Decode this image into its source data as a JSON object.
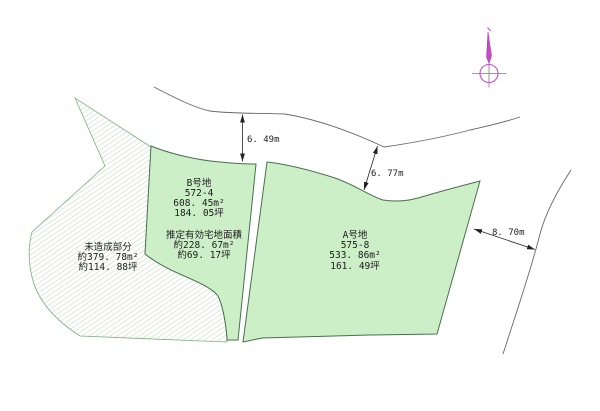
{
  "drawing": {
    "parcel_b": {
      "name": "B号地",
      "lot": "572-4",
      "area_m2": "608. 45m²",
      "area_tsubo": "184. 05坪"
    },
    "effective_area": {
      "title": "推定有効宅地面積",
      "area_m2": "約228. 67m²",
      "area_tsubo": "約69. 17坪"
    },
    "parcel_a": {
      "name": "A号地",
      "lot": "575-8",
      "area_m2": "533. 86m²",
      "area_tsubo": "161. 49坪"
    },
    "undeveloped": {
      "name": "未造成部分",
      "area_m2": "約379. 78m²",
      "area_tsubo": "約114. 88坪"
    },
    "dimensions": {
      "top": "6. 49m",
      "middle": "6. 77m",
      "right": "8. 70m"
    }
  },
  "colors": {
    "parcel_fill": "#cdefc8",
    "parcel_stroke": "#4a6f4f",
    "hatch_line": "#a3c4a3",
    "hatch_boundary": "#7fae7f",
    "road_line": "#676767",
    "dimension_ink": "#222222",
    "compass_magenta": "#c84ac8"
  }
}
